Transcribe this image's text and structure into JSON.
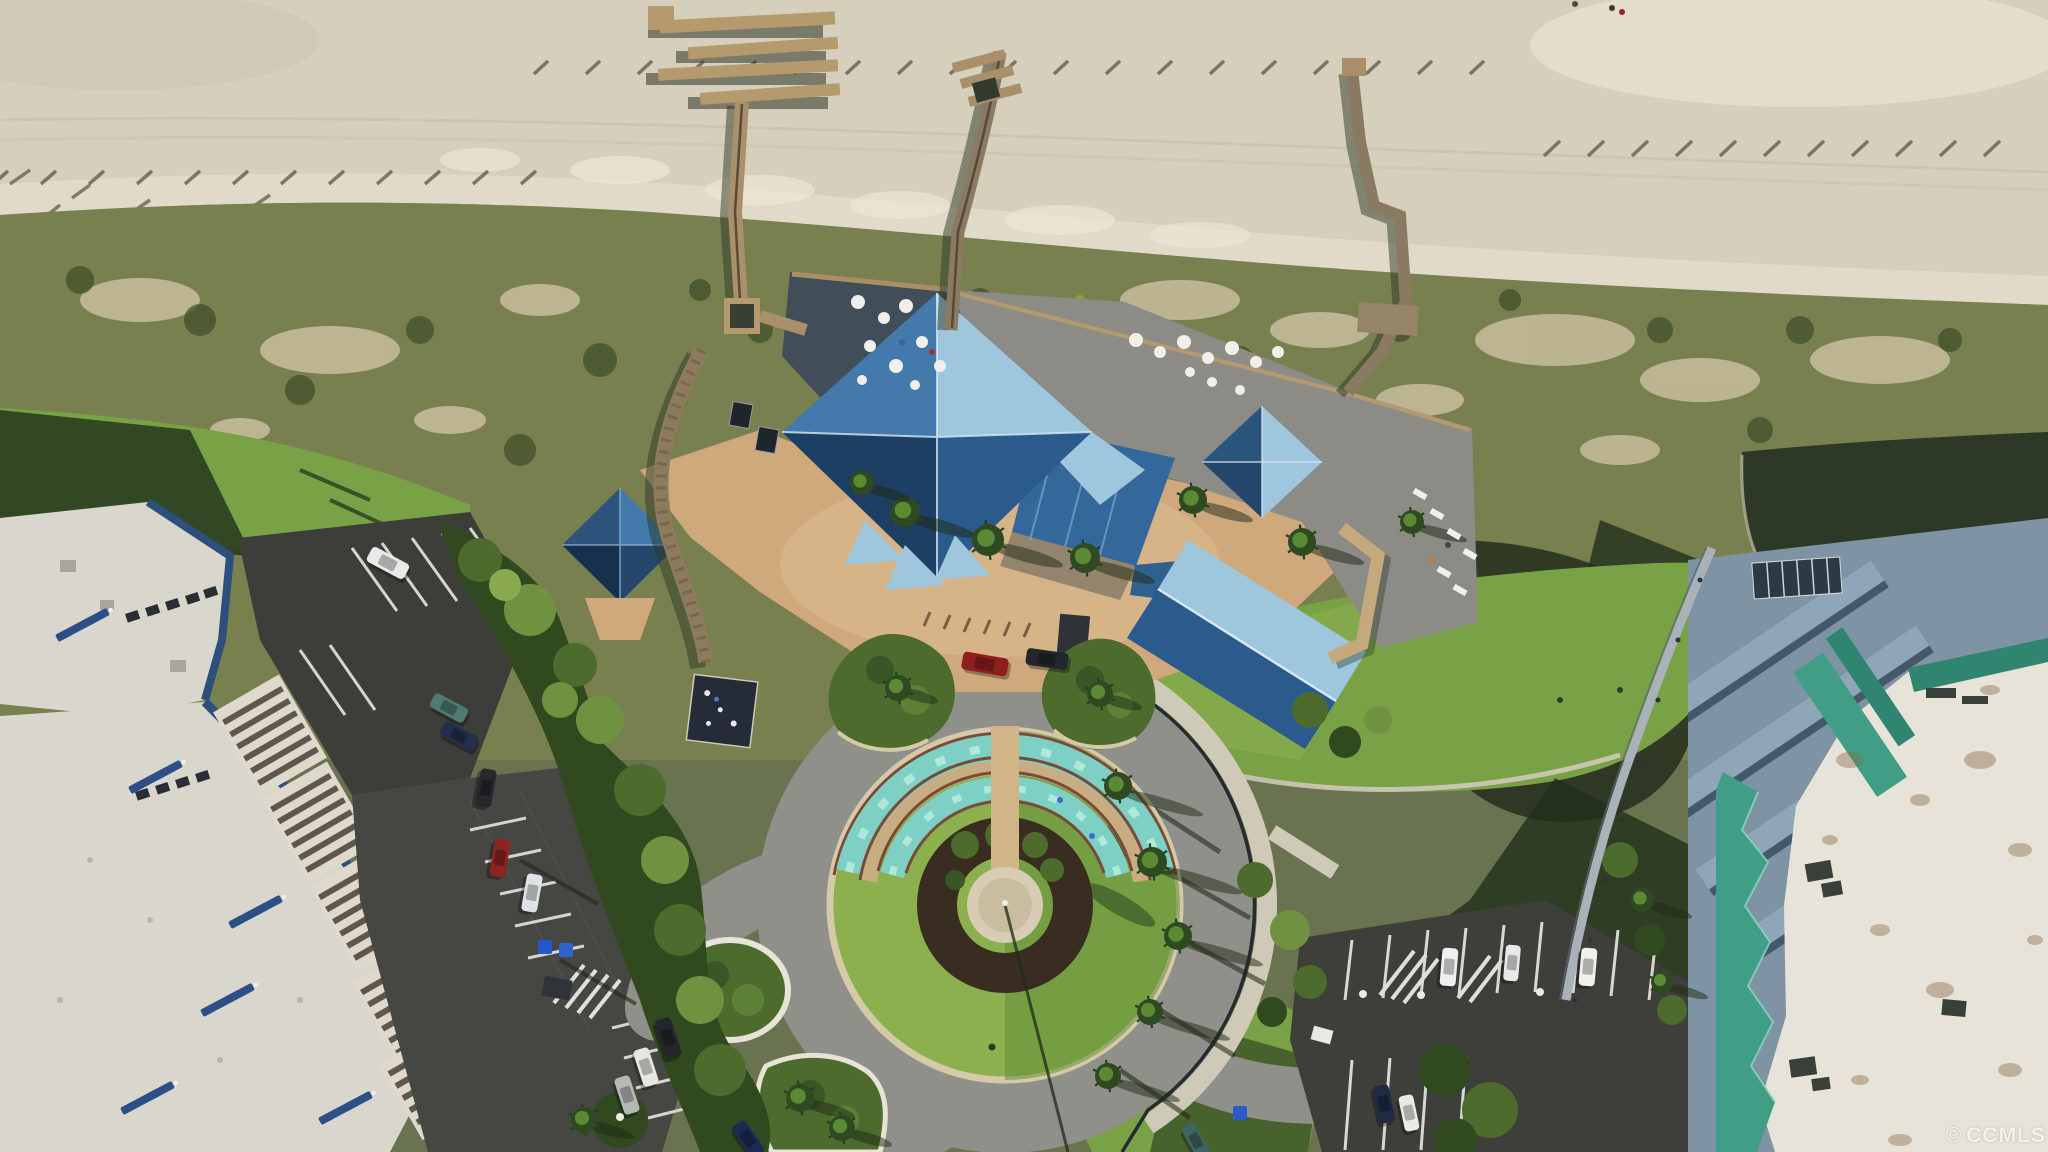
{
  "meta": {
    "type": "aerial-drone-photo",
    "subject": "Top-down aerial of an oceanfront resort: beach and dunes with three wooden boardwalks, blue-pyramid-roof clubhouse with decks, circular entry drive with tiered semicircular fountain and flagpole, white condo building with rooftop loungers at left, teal-roof condo tower at right, parking lots with cars"
  },
  "watermark": {
    "symbol": "©",
    "text": "CCMLS"
  },
  "palette": {
    "sand": "#d6cfbc",
    "sand-bright": "#eadfca",
    "sand-pale": "#f0ead9",
    "dune": "#78804f",
    "dune-sand": "#c9bd9d",
    "tree-dark": "#31491f",
    "tree-mid": "#4c6b2c",
    "tree-light": "#6f9140",
    "grass": "#79a246",
    "grass-bright": "#8db04e",
    "grass-dark": "#55823a",
    "road": "#90908a",
    "road-dark": "#3e3e3b",
    "asphalt": "#464643",
    "concrete": "#cfc9b8",
    "curb": "#e7e3d7",
    "curb-tan": "#d6c9a8",
    "paver": "#cfa87c",
    "paver-light": "#debf94",
    "deck": "#8d8b86",
    "deck-shadow": "#414e5a",
    "wood": "#b59a6e",
    "wood-dark": "#4f4233",
    "walkway": "#8a7a62",
    "roof-dark": "#2b5a8c",
    "roof-mid": "#4379ab",
    "roof-light": "#9ec7de",
    "roof-navy": "#1d3f63",
    "teal-roof": "#3f9e85",
    "teal-dark": "#2f8570",
    "slate": "#8fa6b8",
    "slate-dark": "#44586a",
    "glass": "#2b3a44",
    "roof-white": "#e7e3d8",
    "water": "#7fd0c4",
    "water-light": "#bdeede",
    "stone": "#c9ad82",
    "mulch": "#382d20",
    "pond": "#2d3827",
    "shadow": "#1c2619",
    "fence": "#262b31",
    "white": "#f2f1ec",
    "parapet-blue": "#2d4f7c",
    "lounger-blue": "#2b4f86",
    "bldg-white": "#d9d6cd",
    "slat": "#5f574a"
  },
  "scene": {
    "counts": {
      "boardwalks": 3,
      "blue_pyramid_roofs": 4,
      "fountain_tiers": 2
    },
    "fence_rows": [
      {
        "x0": 548,
        "x1": 1505,
        "y": 58,
        "step": 52,
        "dx": -14,
        "dy": 13
      },
      {
        "x0": 1560,
        "x1": 2040,
        "y": 138,
        "step": 44,
        "dx": -16,
        "dy": 15
      },
      {
        "x0": 8,
        "x1": 540,
        "y": 168,
        "step": 48,
        "dx": -15,
        "dy": 13
      }
    ],
    "beach_people": [
      {
        "x": 1612,
        "y": 8,
        "color": "#3a3a3a"
      },
      {
        "x": 1622,
        "y": 12,
        "color": "#8a2a24"
      },
      {
        "x": 1575,
        "y": 4,
        "color": "#4a4a4a"
      }
    ],
    "palms": [
      {
        "x": 905,
        "y": 512,
        "r": 15,
        "sh": 70
      },
      {
        "x": 988,
        "y": 540,
        "r": 16,
        "sh": 75
      },
      {
        "x": 1085,
        "y": 558,
        "r": 15,
        "sh": 70
      },
      {
        "x": 1193,
        "y": 500,
        "r": 14,
        "sh": 60
      },
      {
        "x": 1302,
        "y": 542,
        "r": 14,
        "sh": 62
      },
      {
        "x": 1412,
        "y": 522,
        "r": 12,
        "sh": 55
      },
      {
        "x": 862,
        "y": 483,
        "r": 12,
        "sh": 48
      },
      {
        "x": 898,
        "y": 688,
        "r": 13,
        "sh": 40
      },
      {
        "x": 1100,
        "y": 694,
        "r": 13,
        "sh": 42
      },
      {
        "x": 1118,
        "y": 786,
        "r": 14,
        "sh": 85
      },
      {
        "x": 1152,
        "y": 862,
        "r": 15,
        "sh": 90
      },
      {
        "x": 1178,
        "y": 936,
        "r": 14,
        "sh": 85
      },
      {
        "x": 1150,
        "y": 1012,
        "r": 13,
        "sh": 80
      },
      {
        "x": 1108,
        "y": 1076,
        "r": 13,
        "sh": 72
      },
      {
        "x": 800,
        "y": 1098,
        "r": 14,
        "sh": 55
      },
      {
        "x": 842,
        "y": 1128,
        "r": 13,
        "sh": 50
      },
      {
        "x": 1642,
        "y": 900,
        "r": 12,
        "sh": 50
      },
      {
        "x": 1662,
        "y": 982,
        "r": 11,
        "sh": 46
      },
      {
        "x": 584,
        "y": 1120,
        "r": 13,
        "sh": 50
      }
    ],
    "cars": [
      {
        "color": "#e9e9e7",
        "x": 388,
        "y": 563,
        "a": 28,
        "l": 42,
        "w": 17
      },
      {
        "color": "#4f7a72",
        "x": 449,
        "y": 708,
        "a": 28,
        "l": 38,
        "w": 16
      },
      {
        "color": "#22304e",
        "x": 459,
        "y": 736,
        "a": 28,
        "l": 38,
        "w": 16
      },
      {
        "color": "#26282c",
        "x": 486,
        "y": 788,
        "a": 100,
        "l": 38,
        "w": 16
      },
      {
        "color": "#8e2420",
        "x": 500,
        "y": 858,
        "a": 100,
        "l": 38,
        "w": 16
      },
      {
        "color": "#dfe3e6",
        "x": 532,
        "y": 893,
        "a": 100,
        "l": 38,
        "w": 16
      },
      {
        "color": "#23262c",
        "x": 668,
        "y": 1038,
        "a": 72,
        "l": 40,
        "w": 17
      },
      {
        "color": "#e6e6e3",
        "x": 646,
        "y": 1067,
        "a": 72,
        "l": 38,
        "w": 16
      },
      {
        "color": "#b6b8b6",
        "x": 627,
        "y": 1095,
        "a": 72,
        "l": 38,
        "w": 16
      },
      {
        "color": "#eef0ee",
        "x": 1449,
        "y": 967,
        "a": 95,
        "l": 38,
        "w": 16
      },
      {
        "color": "#e8e8e6",
        "x": 1512,
        "y": 963,
        "a": 95,
        "l": 36,
        "w": 15
      },
      {
        "color": "#f0f0ec",
        "x": 1588,
        "y": 967,
        "a": 95,
        "l": 38,
        "w": 16
      },
      {
        "color": "#1f2a44",
        "x": 1384,
        "y": 1104,
        "a": 78,
        "l": 38,
        "w": 16
      },
      {
        "color": "#e9e9e7",
        "x": 1409,
        "y": 1113,
        "a": 78,
        "l": 36,
        "w": 15
      },
      {
        "color": "#8e1f1c",
        "x": 985,
        "y": 664,
        "a": 10,
        "l": 46,
        "w": 18
      },
      {
        "color": "#23262a",
        "x": 1047,
        "y": 659,
        "a": 8,
        "l": 42,
        "w": 17
      },
      {
        "color": "#1c2a52",
        "x": 748,
        "y": 1139,
        "a": 55,
        "l": 38,
        "w": 16
      },
      {
        "color": "#3e6660",
        "x": 1196,
        "y": 1141,
        "a": 60,
        "l": 36,
        "w": 15
      }
    ],
    "lounger_clusters": [
      {
        "x": 55,
        "y": 635,
        "a": -28
      },
      {
        "x": 128,
        "y": 787,
        "a": -28
      },
      {
        "x": 228,
        "y": 922,
        "a": -28
      },
      {
        "x": 120,
        "y": 1108,
        "a": -28
      },
      {
        "x": 318,
        "y": 1118,
        "a": -28
      },
      {
        "x": 200,
        "y": 1010,
        "a": -28
      }
    ],
    "bins": [
      {
        "x": 545,
        "y": 947,
        "color": "#2458c8"
      },
      {
        "x": 566,
        "y": 950,
        "color": "#2e64d0"
      },
      {
        "x": 1240,
        "y": 1113,
        "color": "#2a5cc4"
      }
    ]
  }
}
